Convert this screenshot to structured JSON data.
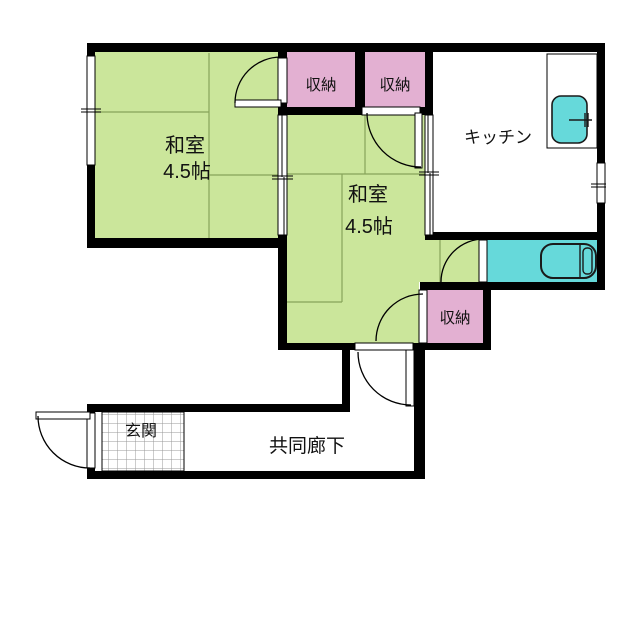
{
  "plan_title": "apartment-floorplan",
  "colors": {
    "tatami_green": "#cbe69b",
    "tatami_line": "#87a35a",
    "closet_pink": "#e3b0d2",
    "water_cyan": "#66d9da",
    "wall_black": "#000000",
    "hatch_gray": "#999999"
  },
  "rooms": {
    "room1": {
      "label": "和室",
      "size": "4.5帖"
    },
    "room2": {
      "label": "和室",
      "size": "4.5帖"
    },
    "kitchen": {
      "label": "キッチン"
    },
    "closet1": {
      "label": "収納"
    },
    "closet2": {
      "label": "収納"
    },
    "closet3": {
      "label": "収納"
    },
    "entrance": {
      "label": "玄関"
    },
    "corridor": {
      "label": "共同廊下"
    }
  }
}
